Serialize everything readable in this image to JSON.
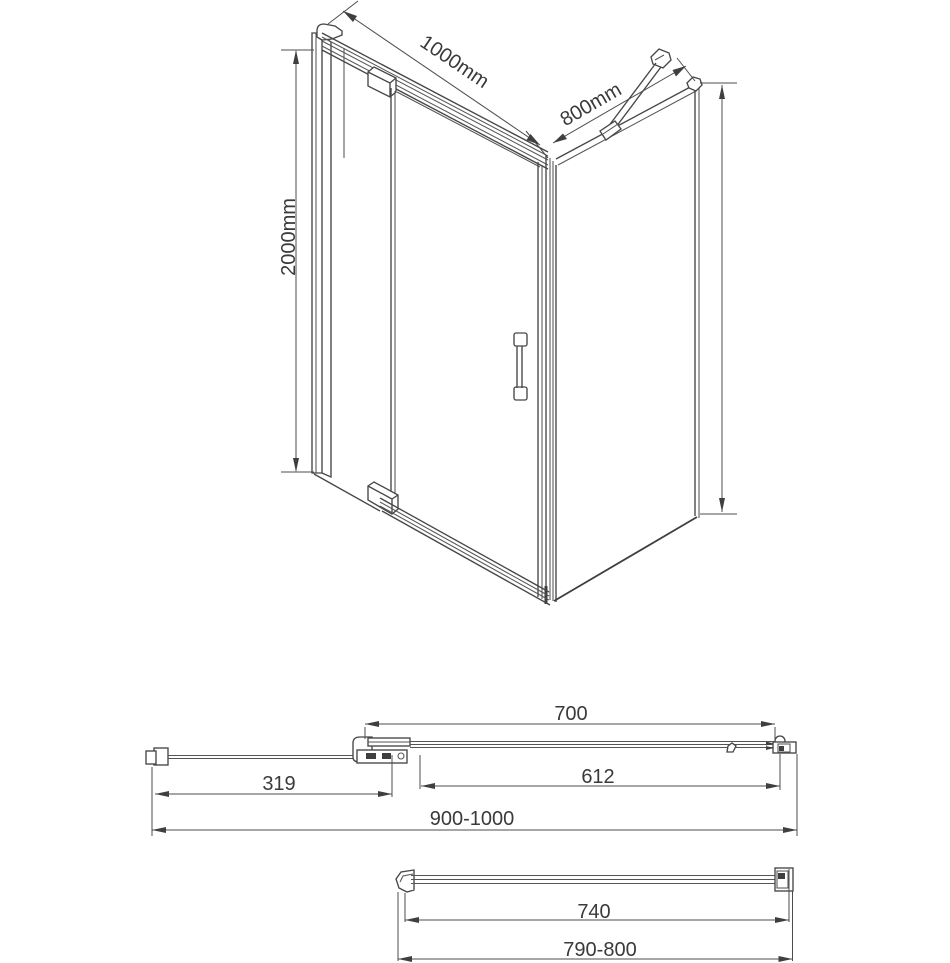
{
  "drawing": {
    "title": "Shower enclosure technical drawing",
    "colors": {
      "line": "#474747",
      "dimension_line": "#4c4c4c",
      "text": "#3a3a3a",
      "background": "#ffffff"
    },
    "views": {
      "isometric": {
        "width_label": "1000mm",
        "depth_label": "800mm",
        "height_label": "2000mm"
      },
      "plan_door_wall": {
        "door_opening": "700",
        "fixed_panel": "319",
        "glass_door": "612",
        "adjustment_range": "900-1000"
      },
      "plan_side_panel": {
        "glass_width": "740",
        "adjustment_range": "790-800"
      }
    }
  }
}
